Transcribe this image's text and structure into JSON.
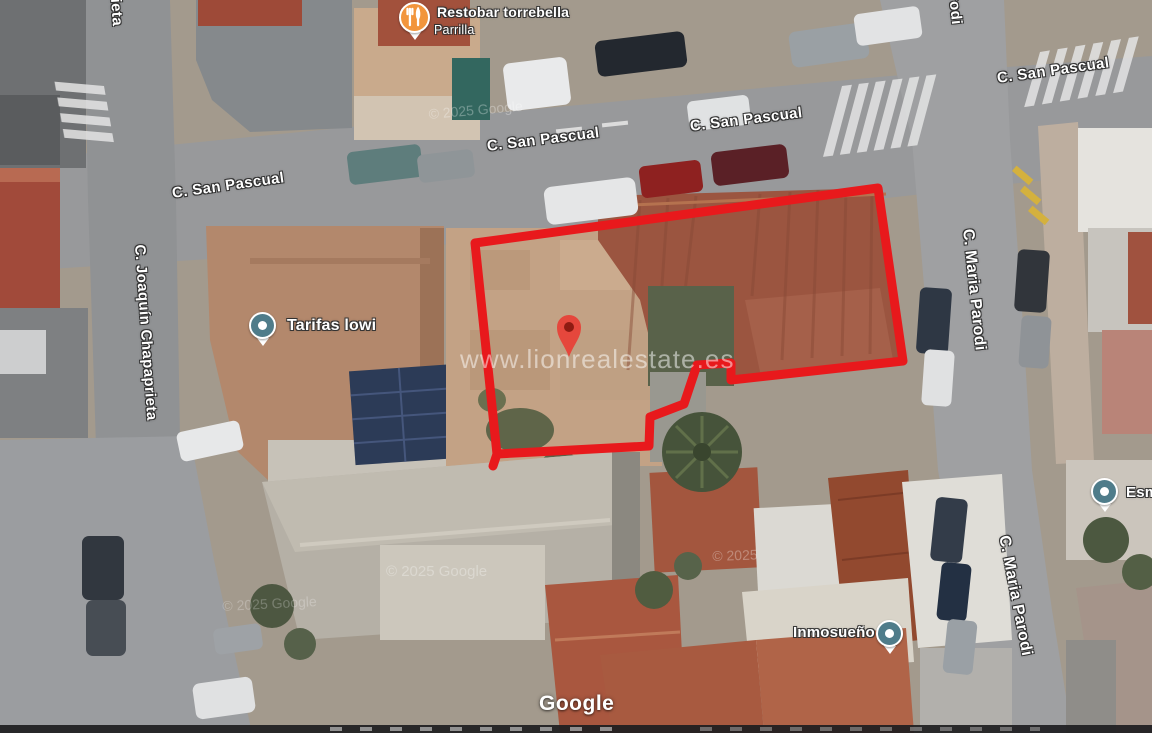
{
  "streets": {
    "san_pascual": "C. San Pascual",
    "joaquin_chapaprieta": "C. Joaquín Chapaprieta",
    "maria_parodi": "C. Maria Parodi",
    "partial_chapaprieta": "ieta",
    "partial_parodi": "rodi"
  },
  "pois": {
    "restobar": {
      "title": "Restobar torrebella",
      "subtitle": "Parrilla",
      "icon": "restaurant-icon",
      "color": "#F2953C"
    },
    "tarifas": {
      "title": "Tarifas lowi",
      "icon": "place-icon",
      "color": "#4F7C8A"
    },
    "inmosueno": {
      "title": "Inmosueño",
      "icon": "place-icon",
      "color": "#4F7C8A"
    },
    "esm_partial": {
      "title": "Esm",
      "icon": "place-icon",
      "color": "#4F7C8A"
    }
  },
  "overlay": {
    "watermark": "www.lionrealestate.es",
    "boundary_color": "#E8191C",
    "pin_body_color": "#E5473C",
    "pin_dot_color": "#8E1B12"
  },
  "credits": {
    "google_logo": "Google",
    "tile_credit": "© 2025 Google",
    "tile_credit_short": "© 2025"
  }
}
